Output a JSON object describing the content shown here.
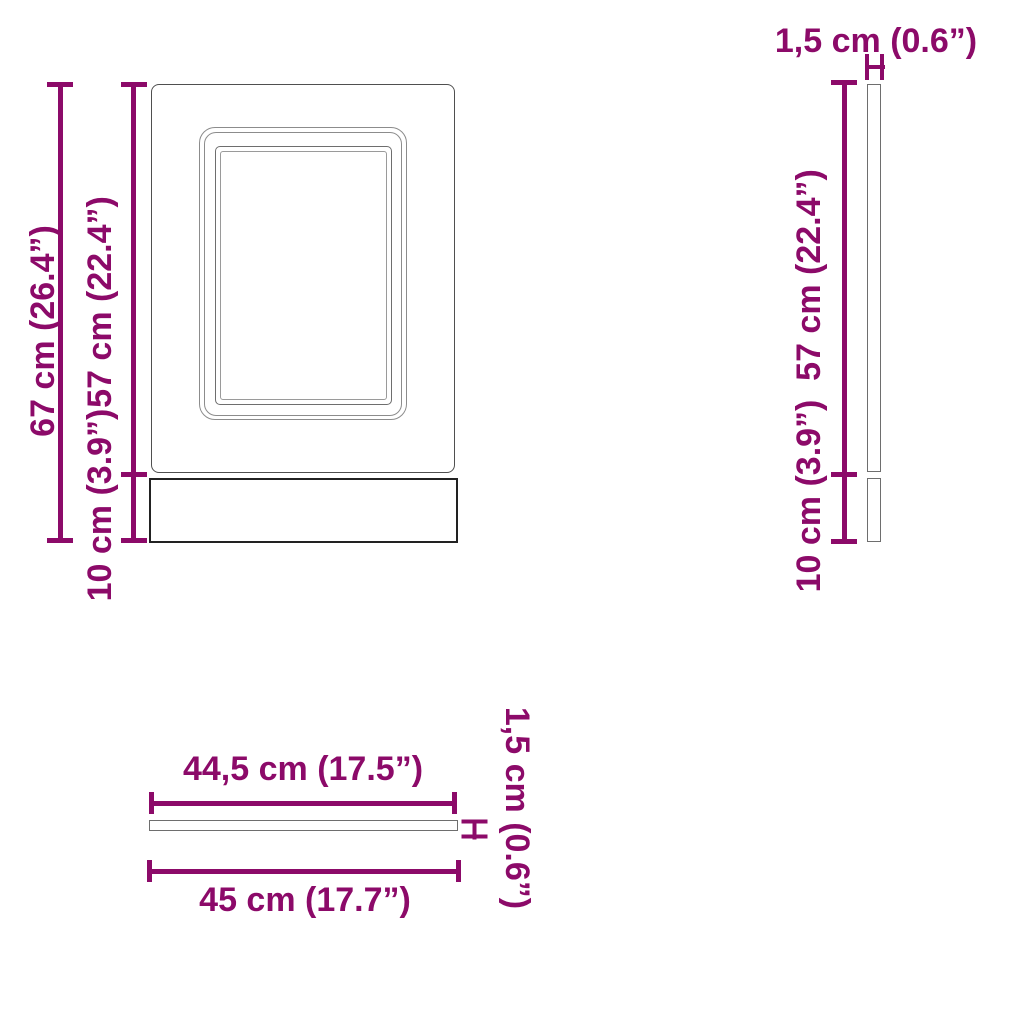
{
  "accent_color": "#8C0A69",
  "front_view": {
    "total_height": "67 cm (26.4”)",
    "door_height": "57 cm (22.4”)",
    "plinth_height": "10 cm (3.9”)"
  },
  "side_view": {
    "thickness": "1,5 cm (0.6”)",
    "door_height": "57 cm (22.4”)",
    "plinth_height": "10 cm (3.9”)"
  },
  "top_view": {
    "panel_width": "44,5 cm (17.5”)",
    "total_width": "45 cm (17.7”)",
    "thickness": "1,5 cm (0.6”)"
  }
}
